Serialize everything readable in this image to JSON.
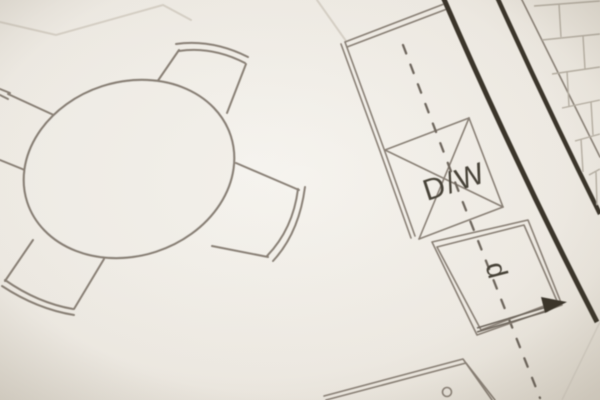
{
  "scene": "close-up photograph of an architectural floor plan drawing showing a round dining table with four chairs and a kitchen counter with dishwasher",
  "labels": {
    "dishwasher": "D/W",
    "cabinet_letter": "d"
  },
  "colors": {
    "paper": "#f3f0ea",
    "paper_edge": "#e2dcd1",
    "line": "#8a8177",
    "faint": "#d8d2c8",
    "wall": "#3a352c",
    "hatch": "#b6afa3",
    "centerline": "#6f685e",
    "text": "#474238"
  }
}
